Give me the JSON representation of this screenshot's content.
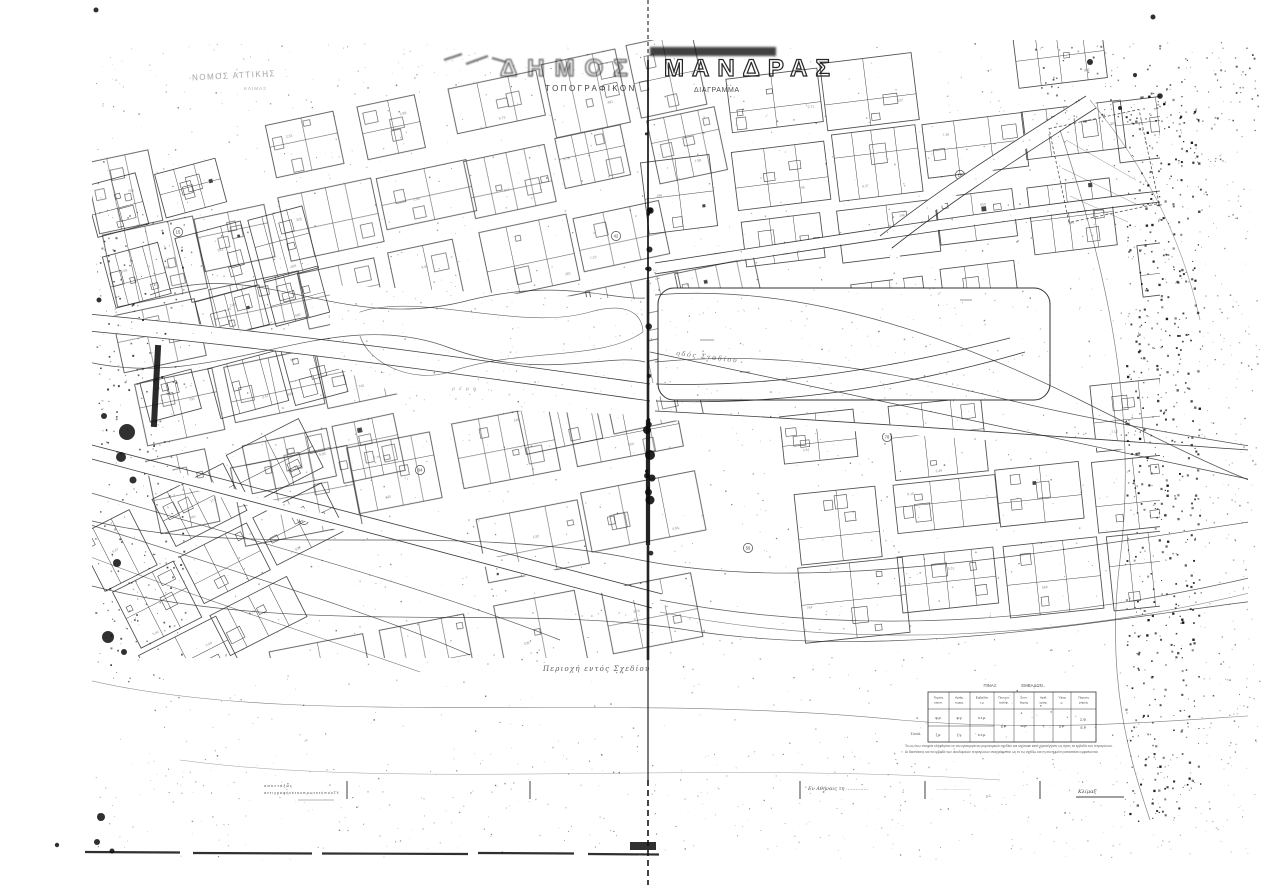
{
  "document": {
    "district_line": "ΝΟΜΟΣ ΑΤΤΙΚΗΣ",
    "district_subline": "ΚΛΙΜΑΞ",
    "title_left": "ΔΗΜΟΣ",
    "title_right": "ΜΑΝΔΡΑΣ",
    "subtitle_left": "ΤΟΠΟΓΡΑΦΙΚΟΝ",
    "subtitle_right": "ΔΙΑΓΡΑΜΜΑ",
    "zone_note": "Περιοχή εντός Σχεδίου",
    "street_label": "οδός Σταδίου",
    "plaza_label": "ρέμα"
  },
  "block_numbers": [
    "15",
    "42",
    "7",
    "78",
    "23",
    "56",
    "ΣΤ",
    "31",
    "18",
    "64"
  ],
  "table": {
    "title_a": "ΠΙΝΑΞ",
    "title_b": "ΕΜΒΑΔΩΝ",
    "headers": [
      "Τομεύς οικοπ.",
      "Αριθμ. τεμαχ.",
      "Εμβαδόν τ.μ.",
      "Ποσοστ. καλύψ.",
      "Συντ. δομής",
      "Αριθ. ορόφ.",
      "Ύψος μ.",
      "Παρατη ρήσεις"
    ],
    "col0": [
      "φ.ρ.",
      "ζ.ρ."
    ],
    "col1": [
      "φ.γ.",
      "ζ.γ."
    ],
    "col2": [
      "ο.τ.μ.",
      "κ.τ.μ."
    ],
    "span_cells": [
      "χ.φ.",
      "ω.ρ.",
      "ς",
      "χ.μ."
    ],
    "last_cell_lines": [
      "Σ.Φ.",
      "Ε.Ρ."
    ],
    "stub": "Σύνολ.",
    "notes": [
      "Τα ως άνω στοιχεία ελήφθησαν εκ του εγκεκριμένου ρυμοτομικού σχεδίου και ισχύουσι κατά προσέγγισιν ως προς τα εμβαδά των τετραγώνων.",
      "Αι διαστάσεις και τα εμβαδά των οικοδομικών τετραγώνων αναγράφονται ως εν τω σχεδίω και τη συνημμένη καταστάσει εμφαίνονται."
    ]
  },
  "margin": {
    "left_line1": "ο  σ υ ν τ ά ξ α ς",
    "left_line2": "α ν τ ι γ ρ α φ ή  ε κ  τ ο υ  π ρ ω τ ο τ ύ π ο υ Τ.Υ.",
    "date_label": "Εν Αθήναις τη ..............",
    "sig_dots": "...............................",
    "sig_sub": "χ.λ.",
    "scale_label": "Κλίμαξ"
  },
  "colors": {
    "ink": "#1b1b1b",
    "paper": "#ffffff"
  }
}
